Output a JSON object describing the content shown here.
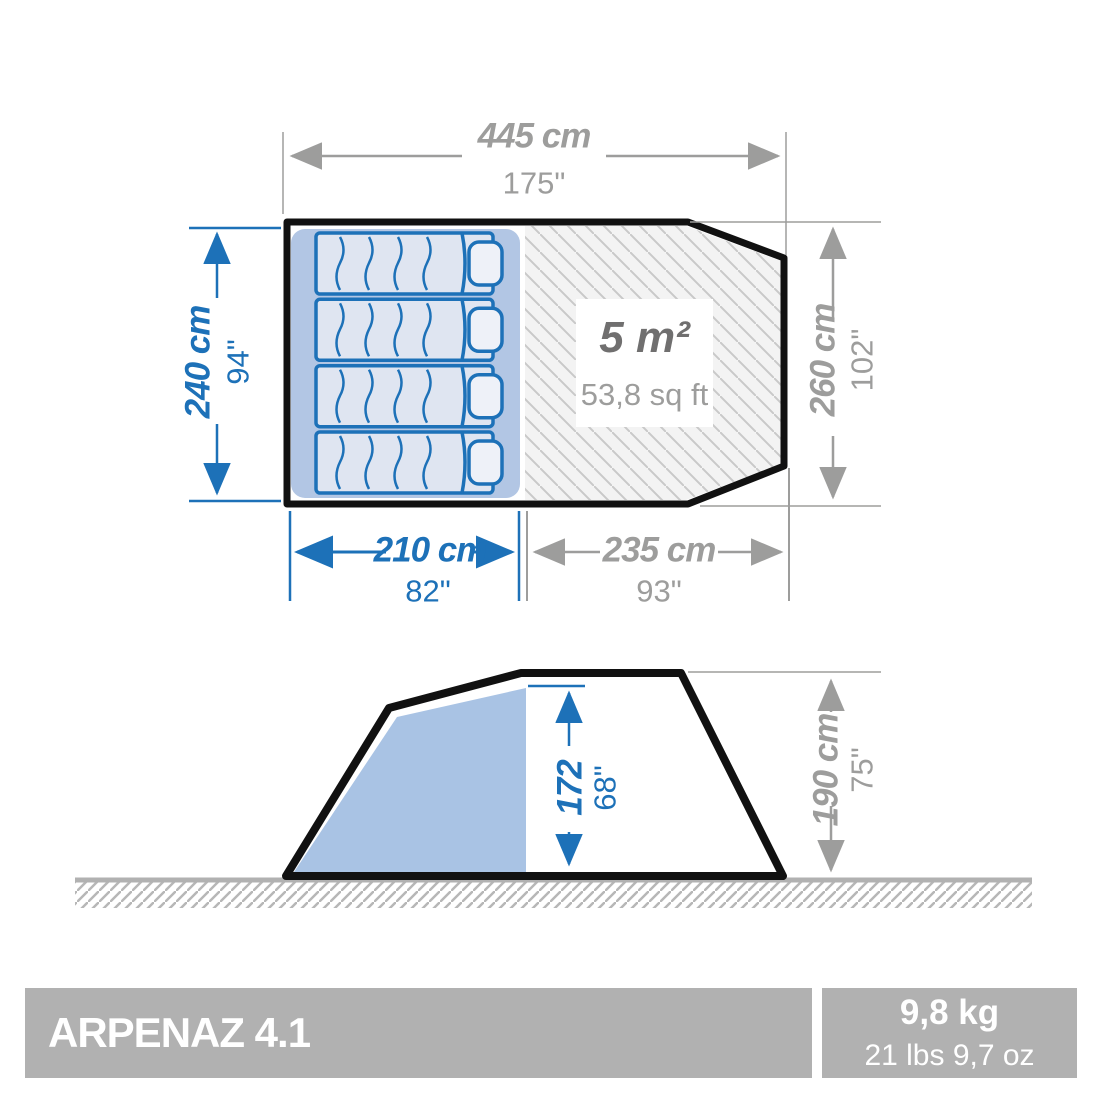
{
  "top_view": {
    "area_label": {
      "metric": "5 m²",
      "imperial": "53,8 sq ft"
    },
    "dim_total_width": {
      "metric": "445 cm",
      "imperial": "175\""
    },
    "dim_depth": {
      "metric": "240 cm",
      "imperial": "94\""
    },
    "dim_right_width": {
      "metric": "260 cm",
      "imperial": "102\""
    },
    "dim_bedroom_width": {
      "metric": "210 cm",
      "imperial": "82\""
    },
    "dim_living_width": {
      "metric": "235 cm",
      "imperial": "93\""
    }
  },
  "side_view": {
    "dim_cabin_height": {
      "metric": "172",
      "imperial": "68\""
    },
    "dim_tent_height": {
      "metric": "190 cm",
      "imperial": "75\""
    }
  },
  "footer": {
    "product_name": "ARPENAZ 4.1",
    "weight_metric": "9,8 kg",
    "weight_imperial": "21 lbs 9,7 oz"
  },
  "colors": {
    "dimension_blue": "#1d71b8",
    "dimension_gray": "#9d9d9c",
    "footer_gray": "#b1b1b1"
  }
}
